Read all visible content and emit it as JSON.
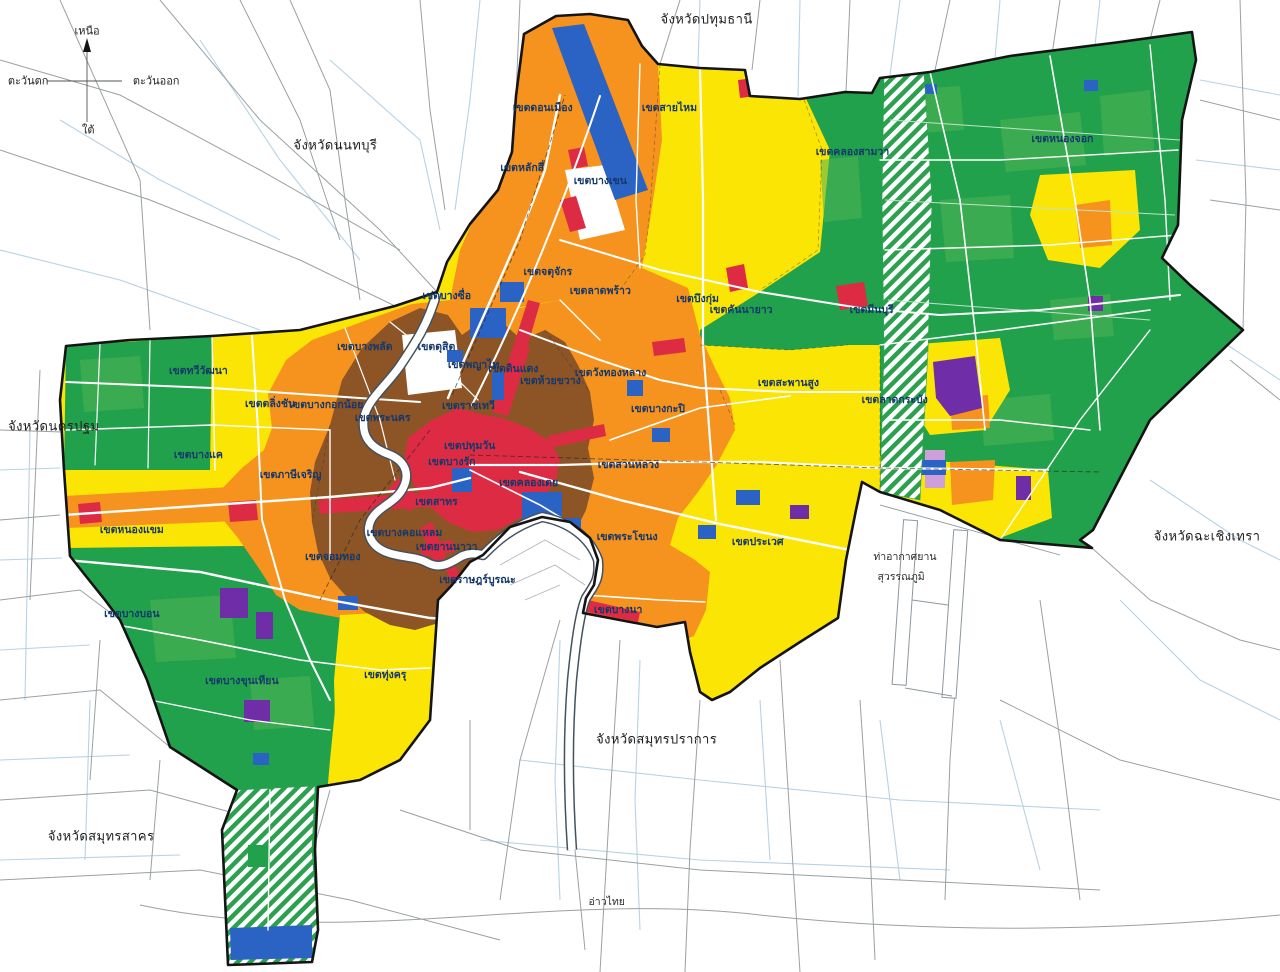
{
  "map": {
    "description": "Bangkok comprehensive land use plan map with surrounding provinces",
    "palette": {
      "residential_low_yellow": "#fbe504",
      "residential_mid_orange": "#f6921e",
      "residential_high_brown": "#8d5426",
      "commercial_red": "#dd2b44",
      "rural_agricultural_green": "#21a14b",
      "rural_green_light": "#52b457",
      "conservation_hatch_green": "#2ba14f",
      "institution_blue": "#2b63c4",
      "industrial_purple": "#6f2da8",
      "warehouse_lavender": "#cf9fd9",
      "boundary_black": "#141414",
      "road_white": "#ffffff",
      "outside_road_gray": "#9aa0a4",
      "canal_blue": "#b7d2e4",
      "label_navy": "#14386b"
    }
  },
  "labels": {
    "compass": [
      {
        "text": "เหนือ",
        "x": 6.8,
        "y": 3.2
      },
      {
        "text": "ตะวันตก",
        "x": 2.2,
        "y": 8.3
      },
      {
        "text": "ตะวันออก",
        "x": 12.2,
        "y": 8.3
      },
      {
        "text": "ใต้",
        "x": 6.9,
        "y": 13.4
      }
    ],
    "provinces": [
      {
        "text": "จังหวัดปทุมธานี",
        "x": 55.2,
        "y": 2.1
      },
      {
        "text": "จังหวัดนนทบุรี",
        "x": 26.2,
        "y": 15.0
      },
      {
        "text": "จังหวัดนครปฐม",
        "x": 4.2,
        "y": 43.9
      },
      {
        "text": "จังหวัดสมุทรสาคร",
        "x": 7.9,
        "y": 86.1
      },
      {
        "text": "จังหวัดสมุทรปราการ",
        "x": 51.3,
        "y": 76.1
      },
      {
        "text": "จังหวัดฉะเชิงเทรา",
        "x": 94.3,
        "y": 55.2
      }
    ],
    "districts": [
      {
        "text": "เขตดอนเมือง",
        "x": 42.4,
        "y": 11.1
      },
      {
        "text": "เขตสายไหม",
        "x": 52.3,
        "y": 11.1
      },
      {
        "text": "เขตหลักสี่",
        "x": 40.8,
        "y": 17.3
      },
      {
        "text": "เขตบางเขน",
        "x": 46.9,
        "y": 18.6
      },
      {
        "text": "เขตคลองสามวา",
        "x": 66.6,
        "y": 15.6
      },
      {
        "text": "เขตหนองจอก",
        "x": 83.0,
        "y": 14.3
      },
      {
        "text": "เขตจตุจักร",
        "x": 42.8,
        "y": 28.0
      },
      {
        "text": "เขตลาดพร้าว",
        "x": 46.9,
        "y": 29.9
      },
      {
        "text": "เขตบางซื่อ",
        "x": 34.9,
        "y": 30.5
      },
      {
        "text": "เขตบึงกุ่ม",
        "x": 54.5,
        "y": 30.8
      },
      {
        "text": "เขตคันนายาว",
        "x": 57.9,
        "y": 31.9
      },
      {
        "text": "เขตมีนบุรี",
        "x": 68.1,
        "y": 31.9
      },
      {
        "text": "เขตบางพลัด",
        "x": 28.5,
        "y": 35.7
      },
      {
        "text": "เขตดุสิต",
        "x": 34.1,
        "y": 35.7
      },
      {
        "text": "เขตพญาไท",
        "x": 37.0,
        "y": 37.6
      },
      {
        "text": "เขตดินแดง",
        "x": 40.1,
        "y": 38.0
      },
      {
        "text": "เขตห้วยขวาง",
        "x": 43.0,
        "y": 39.2
      },
      {
        "text": "เขตวังทองหลาง",
        "x": 47.7,
        "y": 38.4
      },
      {
        "text": "เขตทวีวัฒนา",
        "x": 15.5,
        "y": 38.2
      },
      {
        "text": "เขตตลิ่งชัน",
        "x": 21.1,
        "y": 41.6
      },
      {
        "text": "เขตบางกอกน้อย",
        "x": 25.5,
        "y": 41.7
      },
      {
        "text": "เขตสะพานสูง",
        "x": 61.6,
        "y": 39.4
      },
      {
        "text": "เขตบางกะปิ",
        "x": 51.4,
        "y": 42.1
      },
      {
        "text": "เขตราชเทวี",
        "x": 36.6,
        "y": 41.8
      },
      {
        "text": "เขตพระนคร",
        "x": 29.9,
        "y": 43.0
      },
      {
        "text": "เขตปทุมวัน",
        "x": 36.7,
        "y": 45.9
      },
      {
        "text": "เขตบางรัก",
        "x": 35.3,
        "y": 47.5
      },
      {
        "text": "เขตบางแค",
        "x": 15.5,
        "y": 46.8
      },
      {
        "text": "เขตภาษีเจริญ",
        "x": 22.7,
        "y": 48.9
      },
      {
        "text": "เขตลาดกระบัง",
        "x": 69.9,
        "y": 41.2
      },
      {
        "text": "เขตสวนหลวง",
        "x": 49.1,
        "y": 47.8
      },
      {
        "text": "เขตหนองแขม",
        "x": 10.3,
        "y": 54.5
      },
      {
        "text": "เขตสาทร",
        "x": 34.1,
        "y": 51.6
      },
      {
        "text": "เขตคลองเตย",
        "x": 41.3,
        "y": 49.7
      },
      {
        "text": "เขตบางคอแหลม",
        "x": 31.6,
        "y": 54.8
      },
      {
        "text": "เขตยานนาวา",
        "x": 34.9,
        "y": 56.3
      },
      {
        "text": "เขตจอมทอง",
        "x": 26.0,
        "y": 57.3
      },
      {
        "text": "เขตพระโขนง",
        "x": 49.0,
        "y": 55.2
      },
      {
        "text": "เขตประเวศ",
        "x": 59.2,
        "y": 55.8
      },
      {
        "text": "เขตราษฎร์บูรณะ",
        "x": 37.3,
        "y": 59.7
      },
      {
        "text": "เขตบางนา",
        "x": 48.3,
        "y": 62.8
      },
      {
        "text": "เขตบางบอน",
        "x": 10.3,
        "y": 63.2
      },
      {
        "text": "เขตบางขุนเทียน",
        "x": 18.9,
        "y": 70.1
      },
      {
        "text": "เขตทุ่งครุ",
        "x": 30.1,
        "y": 69.4
      }
    ],
    "other": [
      {
        "text": "ท่าอากาศยาน",
        "x": 70.7,
        "y": 57.3
      },
      {
        "text": "สุวรรณภูมิ",
        "x": 70.4,
        "y": 59.4
      },
      {
        "text": "อ่าวไทย",
        "x": 47.4,
        "y": 92.8
      }
    ]
  }
}
